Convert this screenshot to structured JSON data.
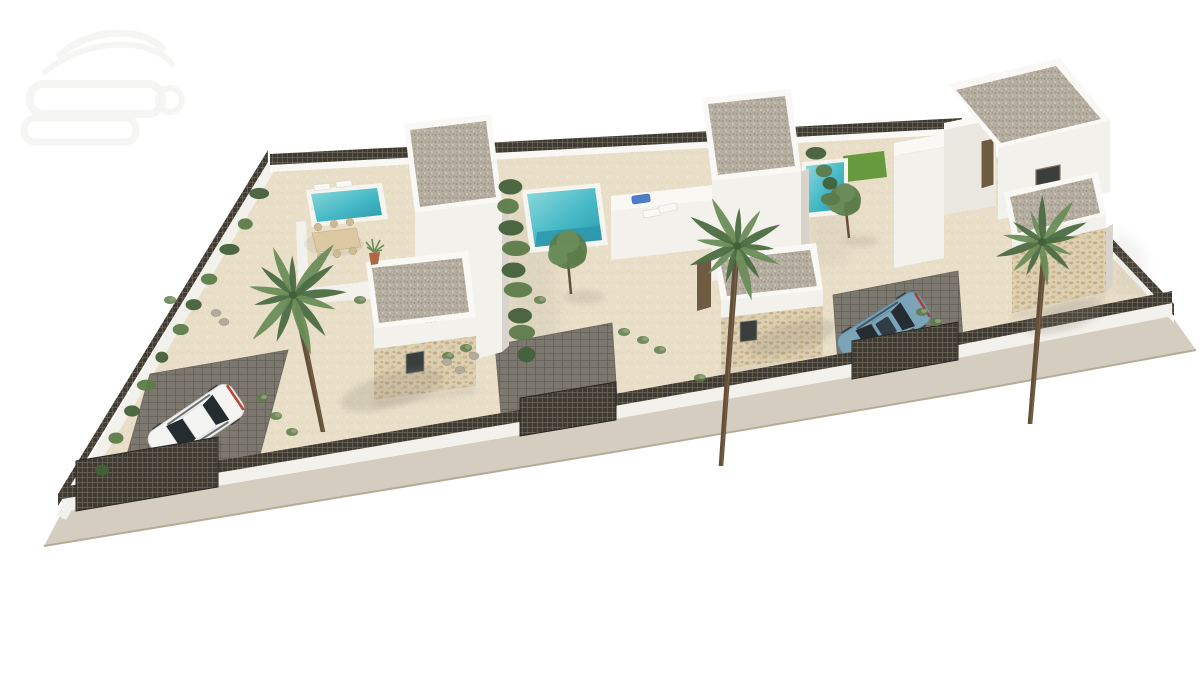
{
  "scene": {
    "description": "Aerial 3D architectural rendering of a walled corner plot with three modern white villas, each with a two-storey tower topped by a gravel flat roof, stone-clad single-storey wings, a private turquoise pool, palm trees, sand-coloured gravel gardens, dark lattice perimeter fencing over low white walls, three driveway gates, a white car parked in the left driveway and a blue car in the right driveway, on a plain white background",
    "style": "photorealistic exterior render",
    "watermark": {
      "present": true,
      "position": "top-left",
      "legible": false
    }
  },
  "plot": {
    "ground": "sand-coloured gravel",
    "boundary": "low white wall topped with dark lattice fence panels",
    "sidewalk": "grey pavement strip along the street edge",
    "gate_count": 3,
    "driveway_count": 3,
    "pool_count": 3
  },
  "villas": [
    {
      "id": 1,
      "position": "left",
      "features": [
        "two-storey tower with gravel roof",
        "stone-clad wing",
        "pool",
        "outdoor dining table with chairs",
        "two sun loungers",
        "potted palm"
      ]
    },
    {
      "id": 2,
      "position": "middle",
      "features": [
        "two-storey tower with gravel roof",
        "roof terrace with three sun loungers",
        "pool with steps",
        "stone-clad wing",
        "driveway gate"
      ]
    },
    {
      "id": 3,
      "position": "right",
      "features": [
        "large two-storey tower with gravel roof",
        "raised lap-pool edge",
        "lawn patch",
        "pool",
        "stone-clad wing",
        "driveway with parked blue car"
      ]
    }
  ],
  "vehicles": [
    {
      "type": "white car",
      "location": "left driveway, parked behind mesh gate"
    },
    {
      "type": "blue car",
      "location": "right driveway, parked behind mesh gate"
    }
  ],
  "vegetation": {
    "palm_count": 3,
    "palms": [
      {
        "cx": 293,
        "cy": 295,
        "r": 56,
        "trunk": [
          297,
          308,
          323,
          432
        ],
        "shadow": [
          392,
          390
        ]
      },
      {
        "cx": 737,
        "cy": 246,
        "r": 48,
        "trunk": [
          736,
          260,
          721,
          466
        ],
        "shadow": [
          792,
          338
        ]
      },
      {
        "cx": 1042,
        "cy": 242,
        "r": 44,
        "trunk": [
          1044,
          256,
          1030,
          424
        ],
        "shadow": [
          1064,
          318
        ]
      }
    ],
    "small_trees": [
      {
        "cx": 568,
        "cy": 250,
        "r": 19,
        "trunk": [
          568,
          262,
          571,
          294
        ]
      },
      {
        "cx": 845,
        "cy": 200,
        "r": 16,
        "trunk": [
          846,
          210,
          849,
          238
        ]
      }
    ],
    "hedgerows": [
      {
        "x1": 509,
        "y1": 186,
        "x2": 524,
        "y2": 356,
        "n": 9,
        "r": 11
      },
      {
        "x1": 818,
        "y1": 152,
        "x2": 833,
        "y2": 202,
        "n": 4,
        "r": 9
      },
      {
        "x1": 100,
        "y1": 468,
        "x2": 260,
        "y2": 196,
        "n": 11,
        "r": 8
      }
    ],
    "ground_shrubs": [
      [
        262,
        398
      ],
      [
        276,
        416
      ],
      [
        292,
        432
      ],
      [
        448,
        356
      ],
      [
        466,
        348
      ],
      [
        624,
        332
      ],
      [
        643,
        340
      ],
      [
        660,
        350
      ],
      [
        922,
        312
      ],
      [
        936,
        322
      ],
      [
        700,
        378
      ],
      [
        540,
        300
      ],
      [
        360,
        300
      ],
      [
        170,
        300
      ]
    ],
    "rocks": [
      [
        447,
        362
      ],
      [
        460,
        370
      ],
      [
        474,
        356
      ],
      [
        216,
        313
      ],
      [
        224,
        322
      ]
    ]
  },
  "colors": {
    "background": "#ffffff",
    "watermark": "#f0efec",
    "sand": "#e9dfc9",
    "sidewalk": "#d5cec0",
    "kerb": "#b5ab99",
    "wallLit": "#f3f1eb",
    "wallMid": "#eae7e0",
    "wallShade": "#d8d4cb",
    "parapet": "#f9f8f5",
    "gravelBase": "#b6aea1",
    "gravelDot": "#968e7f",
    "stoneBase": "#ddd0b2",
    "stoneDot": "#c2ab85",
    "poolWater": "#45b9c6",
    "poolDeep": "#2d97ab",
    "poolLight": "#8fd9de",
    "poolRim": "#f6f4ee",
    "lawn": "#679a3e",
    "hedge": "#5d7b4a",
    "hedgeDark": "#43603a",
    "palmFrond": "#6a8c58",
    "palmFrondDark": "#4c6c42",
    "palmTrunk": "#64503a",
    "fenceDark": "#3f3a32",
    "latticeLight": "#7a7263",
    "cobble": "#7d786f",
    "cobbleJoint": "#635f57",
    "carWhite": "#f4f4f2",
    "carWhiteShade": "#d9d9d6",
    "carBlue": "#7ca4b9",
    "carBlueShade": "#5d87a0",
    "carWindow": "#252c31",
    "taillight": "#b33227",
    "loungerBlue": "#4f7ec9",
    "doorBrown": "#6f5b42",
    "windowDark": "#3a3f3d",
    "tableTan": "#dcc9a2",
    "chairTan": "#cdbb93",
    "potTerracotta": "#ad6744",
    "rock": "#b3ab9c",
    "shadow": "#8a8274"
  }
}
